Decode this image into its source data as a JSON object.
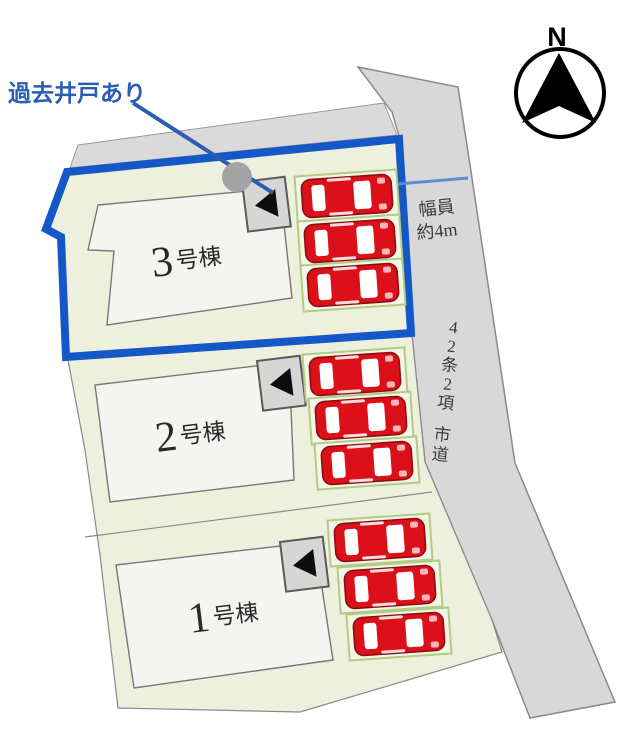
{
  "annotation": {
    "text": "過去井戸あり"
  },
  "compass": {
    "label": "N"
  },
  "road": {
    "name": "42条2項 市道",
    "name_chars": [
      "4",
      "2",
      "条",
      "2",
      "項",
      "市",
      "道"
    ],
    "width_sign": {
      "line1": "幅員",
      "line2": "約4m"
    }
  },
  "buildings": [
    {
      "id": "3",
      "number": "3",
      "suffix": "号棟"
    },
    {
      "id": "2",
      "number": "2",
      "suffix": "号棟"
    },
    {
      "id": "1",
      "number": "1",
      "suffix": "号棟"
    }
  ],
  "colors": {
    "highlight_blue": "#1458c8",
    "annotation_blue": "#2a5db4",
    "car_red": "#dc1019",
    "site_fill": "#edf0dd",
    "road_fill": "#d8d8d8",
    "building_fill": "#f4f4f1"
  }
}
